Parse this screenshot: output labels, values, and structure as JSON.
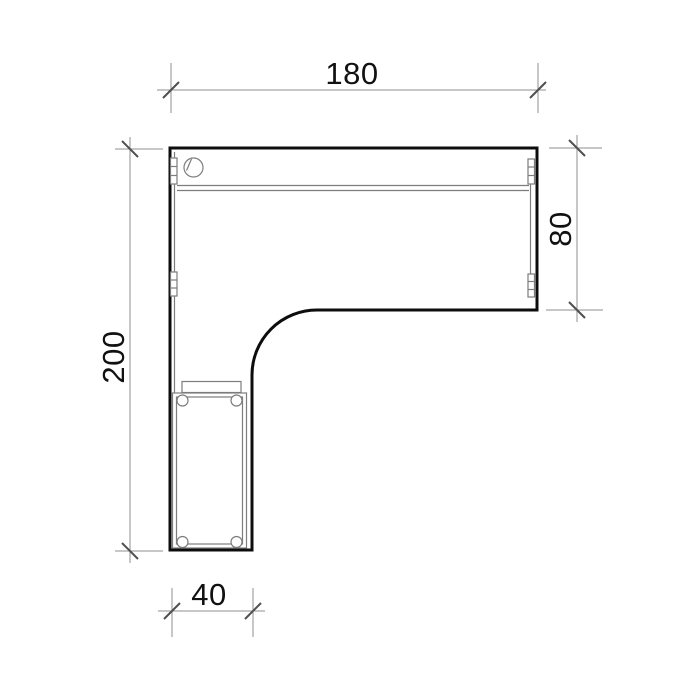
{
  "drawing": {
    "kind": "furniture-plan-top-view",
    "subject": "l-shaped-desk"
  },
  "dimensions": {
    "top_width": "180",
    "right_depth": "80",
    "left_depth": "200",
    "bottom_width": "40"
  },
  "colors": {
    "background": "#ffffff",
    "desk_outline": "#0d0d0d",
    "dimension_line": "#8f8f8f",
    "tick_mark": "#4f4f4f",
    "detail_line": "#7d7d7d",
    "label_text": "#111111"
  },
  "icons": {
    "grommet": "cable-grommet-icon",
    "caster": "caster-wheel-icon",
    "bracket": "connector-bracket-icon"
  }
}
